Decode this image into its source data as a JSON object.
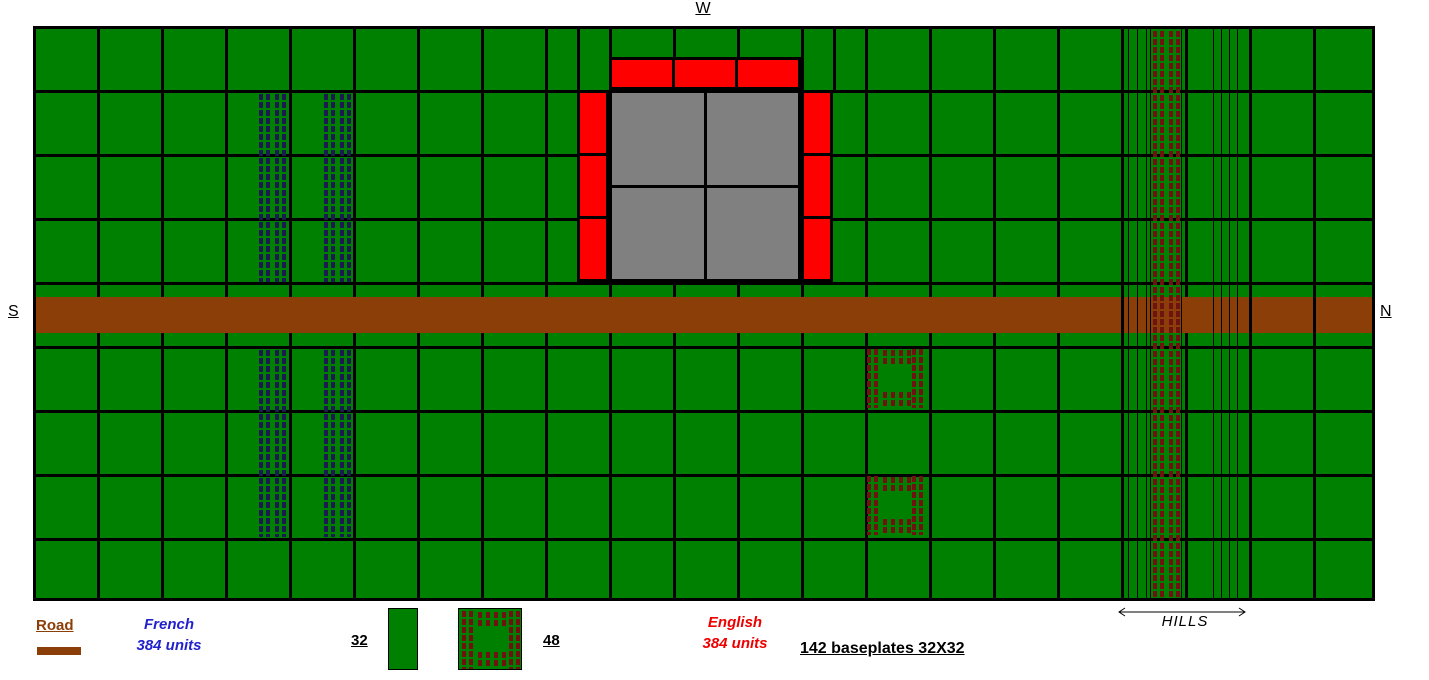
{
  "diagram_title": "Wargame battlefield layout plan",
  "compass": {
    "west": "W",
    "south": "S",
    "north": "N"
  },
  "legend": {
    "road_label": "Road",
    "french": {
      "name": "French",
      "units": "384 units"
    },
    "english": {
      "name": "English",
      "units": "384 units"
    },
    "formation_32": "32",
    "formation_48": "48",
    "baseplates_note": "142 baseplates 32X32",
    "hills_label": "HILLS"
  },
  "colors": {
    "field_green": "#008000",
    "grid_line": "#000000",
    "road_brown": "#8B3E08",
    "castle_wall_red": "#FF0000",
    "keep_gray": "#808080",
    "french_stud_blue": "#1B1B52",
    "english_stud_red": "#6F1212",
    "french_text": "#2222CC",
    "english_text": "#EE0000"
  },
  "map": {
    "grid": {
      "columns": 21,
      "rows": 9,
      "baseplate": "32X32",
      "baseplate_count": 142
    },
    "road": {
      "orientation": "horizontal",
      "runs": "south-to-north across middle row",
      "crossed_by_hill_contours": true
    },
    "castle": {
      "position": "top center (west side)",
      "keep": "2x2 gray blocks",
      "walls": "red segments on north band, east and west columns"
    },
    "hills": {
      "position": "right (north) side, full height",
      "contour_lines_left": 4,
      "contour_lines_right": 5,
      "occupied_by": "english column formation"
    },
    "armies": {
      "french": {
        "total_units": 384,
        "formation_type": "column (32 per baseplate row)",
        "positions": [
          "two column strips north of road, rows 2-4",
          "two column strips south of road, rows 6-8"
        ]
      },
      "english": {
        "total_units": 384,
        "formation_types": [
          "column (32)",
          "hollow square (48)"
        ],
        "positions": [
          "full-height column strip on the hills",
          "two hollow squares south of road near hills side"
        ]
      }
    }
  }
}
